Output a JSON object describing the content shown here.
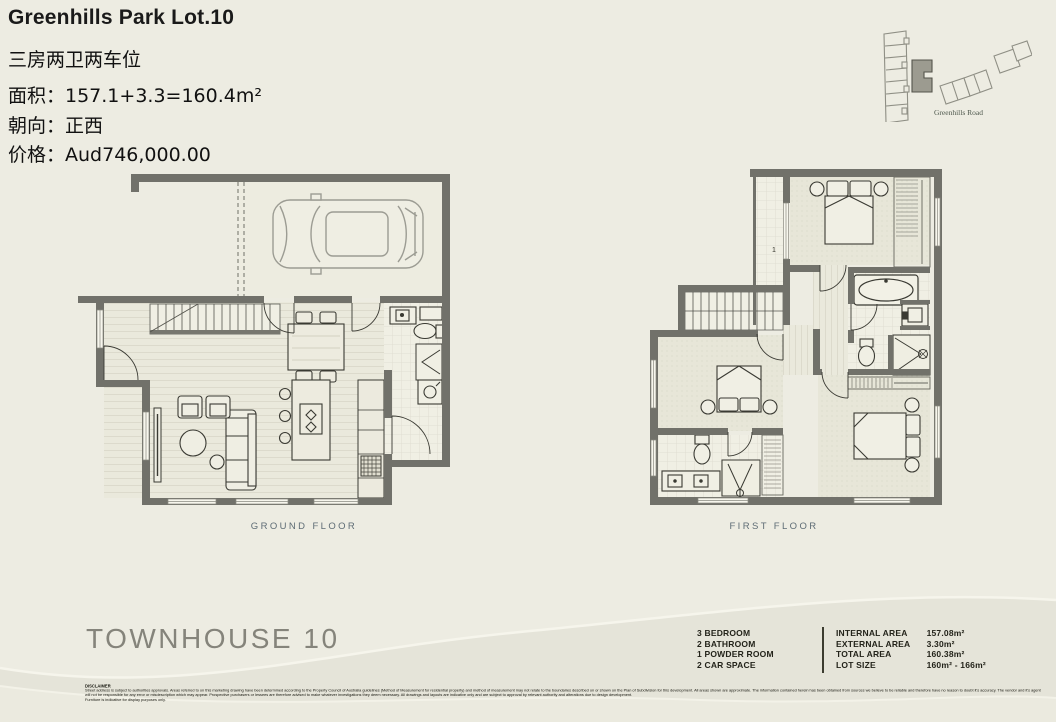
{
  "header": {
    "title": "Greenhills Park Lot.10",
    "subtitle_cn": "三房两卫两车位",
    "area_line": "面积：157.1+3.3=160.4m²",
    "facing_line": "朝向：正西",
    "price_line": "价格：Aud746,000.00"
  },
  "site_plan": {
    "road_label": "Greenhills Road"
  },
  "plans": {
    "ground_label": "GROUND FLOOR",
    "first_label": "FIRST FLOOR",
    "first_balcony_label": "1"
  },
  "footer": {
    "project_title": "TOWNHOUSE 10",
    "features": [
      "3 BEDROOM",
      "2 BATHROOM",
      "1 POWDER ROOM",
      "2 CAR SPACE"
    ],
    "areas": [
      {
        "label": "INTERNAL AREA",
        "value": "157.08m²"
      },
      {
        "label": "EXTERNAL AREA",
        "value": "3.30m²"
      },
      {
        "label": "TOTAL AREA",
        "value": "160.38m²"
      },
      {
        "label": "LOT SIZE",
        "value": "160m² - 166m²"
      }
    ],
    "disclaimer_title": "DISCLAIMER",
    "disclaimer_text": "Street address is subject to authorities approvals. Areas referred to on this marketing drawing have been determined according to the Property Council of Australia guidelines (Method of Measurement for residential property) and method of measurement may not relate to the boundaries described on or shown on the Plan of Subdivision for this development. All areas shown are approximate. The information contained herein has been obtained from sources we believe to be reliable and therefore have no reason to doubt it's accuracy. The vendor and it's agent will not be responsible for any error or misdescription which may appear. Prospective purchasers or lessees are therefore advised to make whatever investigations they deem necessary. All drawings and layouts are indicative only and are subject to approval by relevant authority and alterations due to design development.",
    "disclaimer_note": "Furniture is indicative for display purposes only."
  },
  "colors": {
    "background": "#EDECE2",
    "wall": "#71716A",
    "caption_text": "#5E6C75",
    "muted_title": "#85847B",
    "site_highlight": "#9C9B90"
  }
}
